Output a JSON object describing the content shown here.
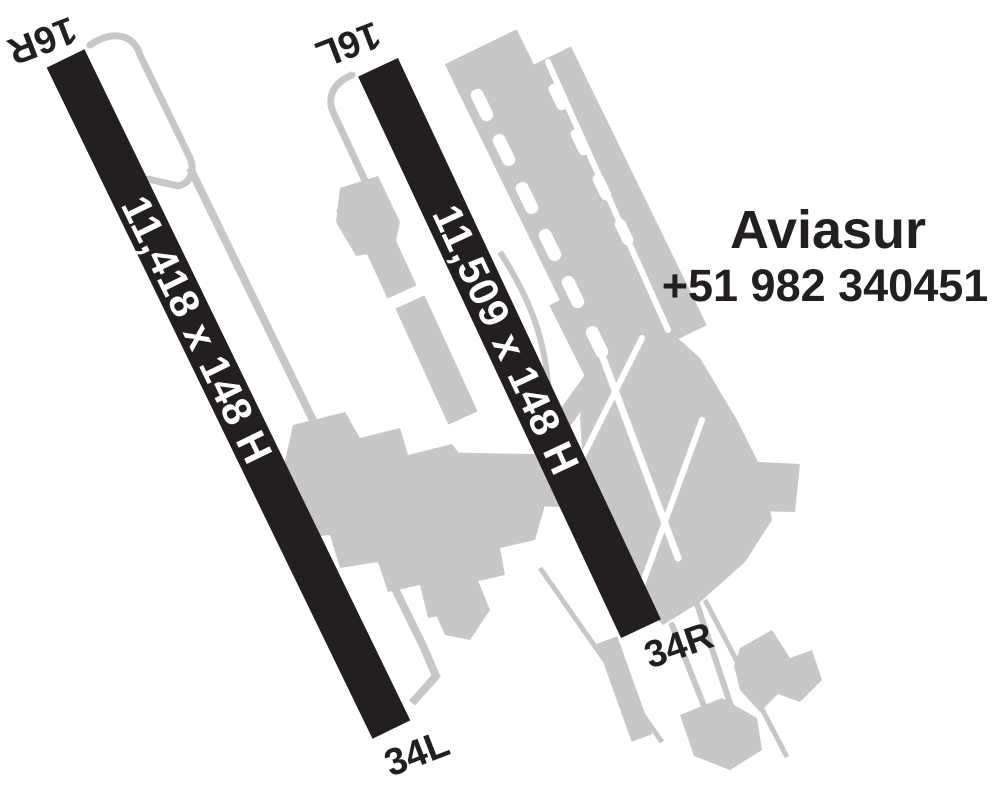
{
  "diagram": {
    "title": "Airport runway diagram",
    "colors": {
      "background": "#ffffff",
      "runway": "#231f20",
      "taxiway": "#c6c7c9",
      "runway_text": "#ffffff",
      "label_text": "#231f20"
    },
    "runways": [
      {
        "id": "left",
        "end_top": "16R",
        "end_bottom": "34L",
        "dimensions": "11,418 x 148 H"
      },
      {
        "id": "right",
        "end_top": "16L",
        "end_bottom": "34R",
        "dimensions": "11,509 x 148 H"
      }
    ],
    "annotation": {
      "company": "Aviasur",
      "phone": "+51 982 340451"
    }
  }
}
